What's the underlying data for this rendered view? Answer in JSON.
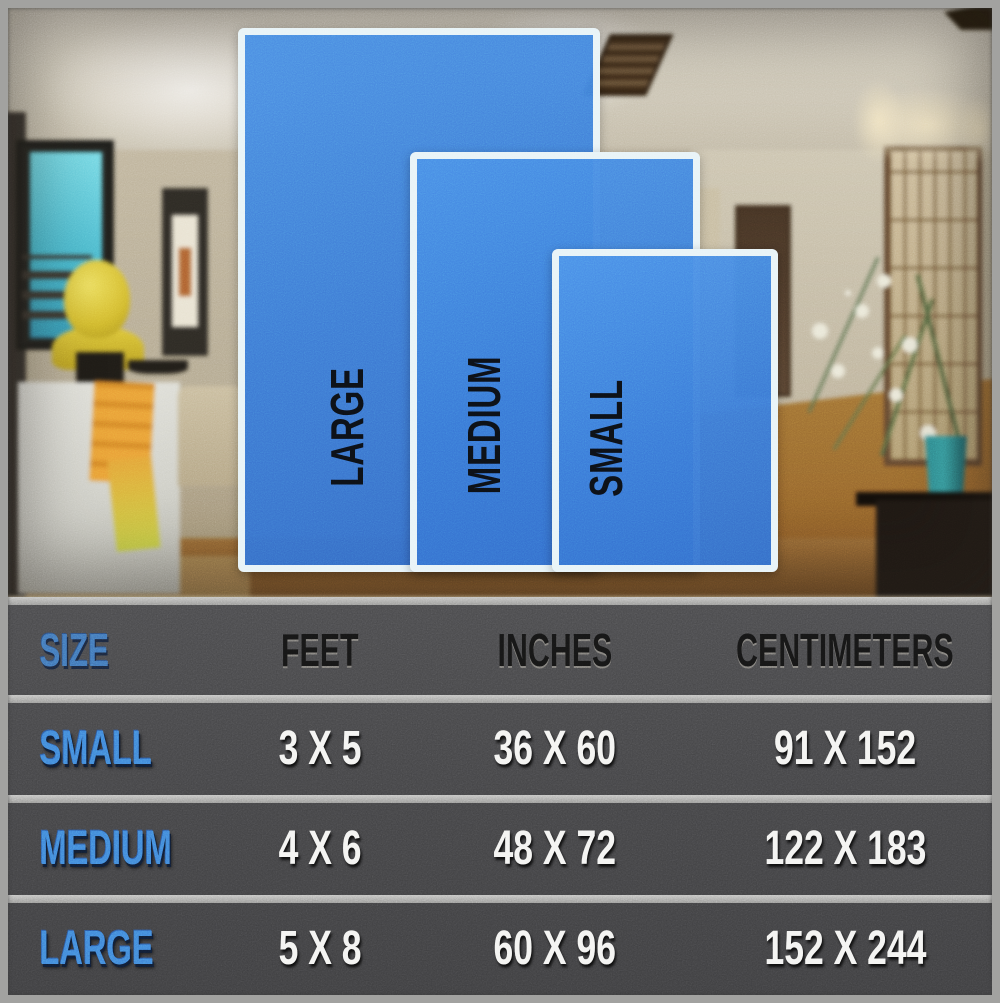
{
  "title": "Rug size comparison chart",
  "overlay": {
    "rugs": [
      {
        "name": "large-rug",
        "label": "LARGE"
      },
      {
        "name": "medium-rug",
        "label": "MEDIUM"
      },
      {
        "name": "small-rug",
        "label": "SMALL"
      }
    ],
    "rug_color": "#3b76d6",
    "rug_border_color": "#e7f3f7"
  },
  "table": {
    "headers": {
      "size": "SIZE",
      "feet": "FEET",
      "inches": "INCHES",
      "centimeters": "CENTIMETERS"
    },
    "rows": [
      {
        "size": "SMALL",
        "feet": "3 X 5",
        "inches": "36 X 60",
        "centimeters": "91 X 152"
      },
      {
        "size": "MEDIUM",
        "feet": "4 X 6",
        "inches": "48 X 72",
        "centimeters": "122 X 183"
      },
      {
        "size": "LARGE",
        "feet": "5 X 8",
        "inches": "60 X 96",
        "centimeters": "152 X 244"
      }
    ],
    "label_color": "#3f82d8",
    "value_color": "#f3f3f1",
    "panel_color": "#434345"
  },
  "chart_data": {
    "type": "table",
    "title": "Rug size comparison chart",
    "columns": [
      "SIZE",
      "FEET",
      "INCHES",
      "CENTIMETERS"
    ],
    "rows": [
      [
        "SMALL",
        "3 X 5",
        "36 X 60",
        "91 X 152"
      ],
      [
        "MEDIUM",
        "4 X 6",
        "48 X 72",
        "122 X 183"
      ],
      [
        "LARGE",
        "5 X 8",
        "60 X 96",
        "152 X 244"
      ]
    ]
  }
}
